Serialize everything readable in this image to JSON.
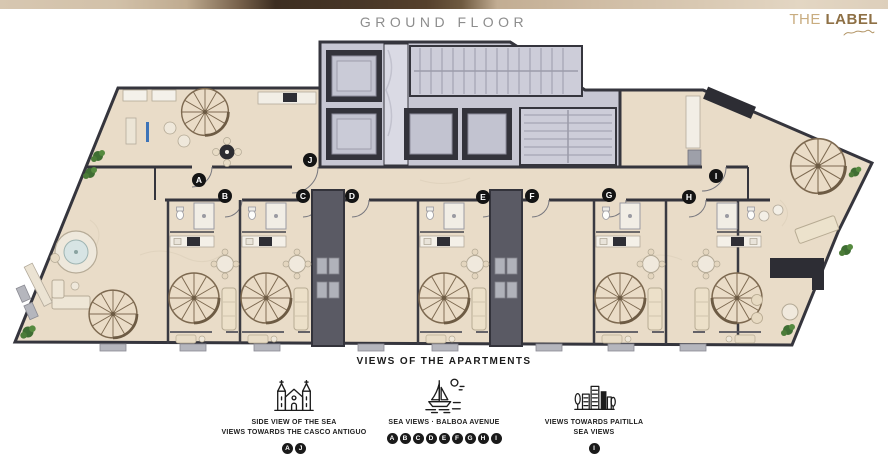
{
  "header": {
    "title": "GROUND FLOOR",
    "logo": {
      "the": "THE",
      "label": "LABEL"
    }
  },
  "plan": {
    "badges": [
      {
        "label": "A",
        "x": 199,
        "y": 180
      },
      {
        "label": "B",
        "x": 225,
        "y": 196
      },
      {
        "label": "C",
        "x": 303,
        "y": 196
      },
      {
        "label": "D",
        "x": 352,
        "y": 196
      },
      {
        "label": "E",
        "x": 483,
        "y": 197
      },
      {
        "label": "F",
        "x": 532,
        "y": 196
      },
      {
        "label": "G",
        "x": 609,
        "y": 195
      },
      {
        "label": "H",
        "x": 689,
        "y": 197
      },
      {
        "label": "I",
        "x": 716,
        "y": 176
      },
      {
        "label": "J",
        "x": 310,
        "y": 160
      }
    ]
  },
  "legend": {
    "title": "VIEWS OF THE APARTMENTS",
    "items": [
      {
        "icon": "cathedral-icon",
        "lines": [
          "SIDE VIEW OF THE SEA",
          "VIEWS TOWARDS THE CASCO ANTIGUO"
        ],
        "badges": [
          "A",
          "J"
        ]
      },
      {
        "icon": "sailboat-icon",
        "lines": [
          "SEA VIEWS · BALBOA AVENUE"
        ],
        "badges": [
          "A",
          "B",
          "C",
          "D",
          "E",
          "F",
          "G",
          "H",
          "I"
        ]
      },
      {
        "icon": "skyline-icon",
        "lines": [
          "VIEWS TOWARDS PAITILLA",
          "SEA VIEWS"
        ],
        "badges": [
          "I"
        ]
      }
    ]
  },
  "colors": {
    "accent_gold": "#a98a5d",
    "wall": "#35353d",
    "floor": "#e9dcc8",
    "core_floor": "#c7c7d3",
    "badge_bg": "#141414"
  }
}
